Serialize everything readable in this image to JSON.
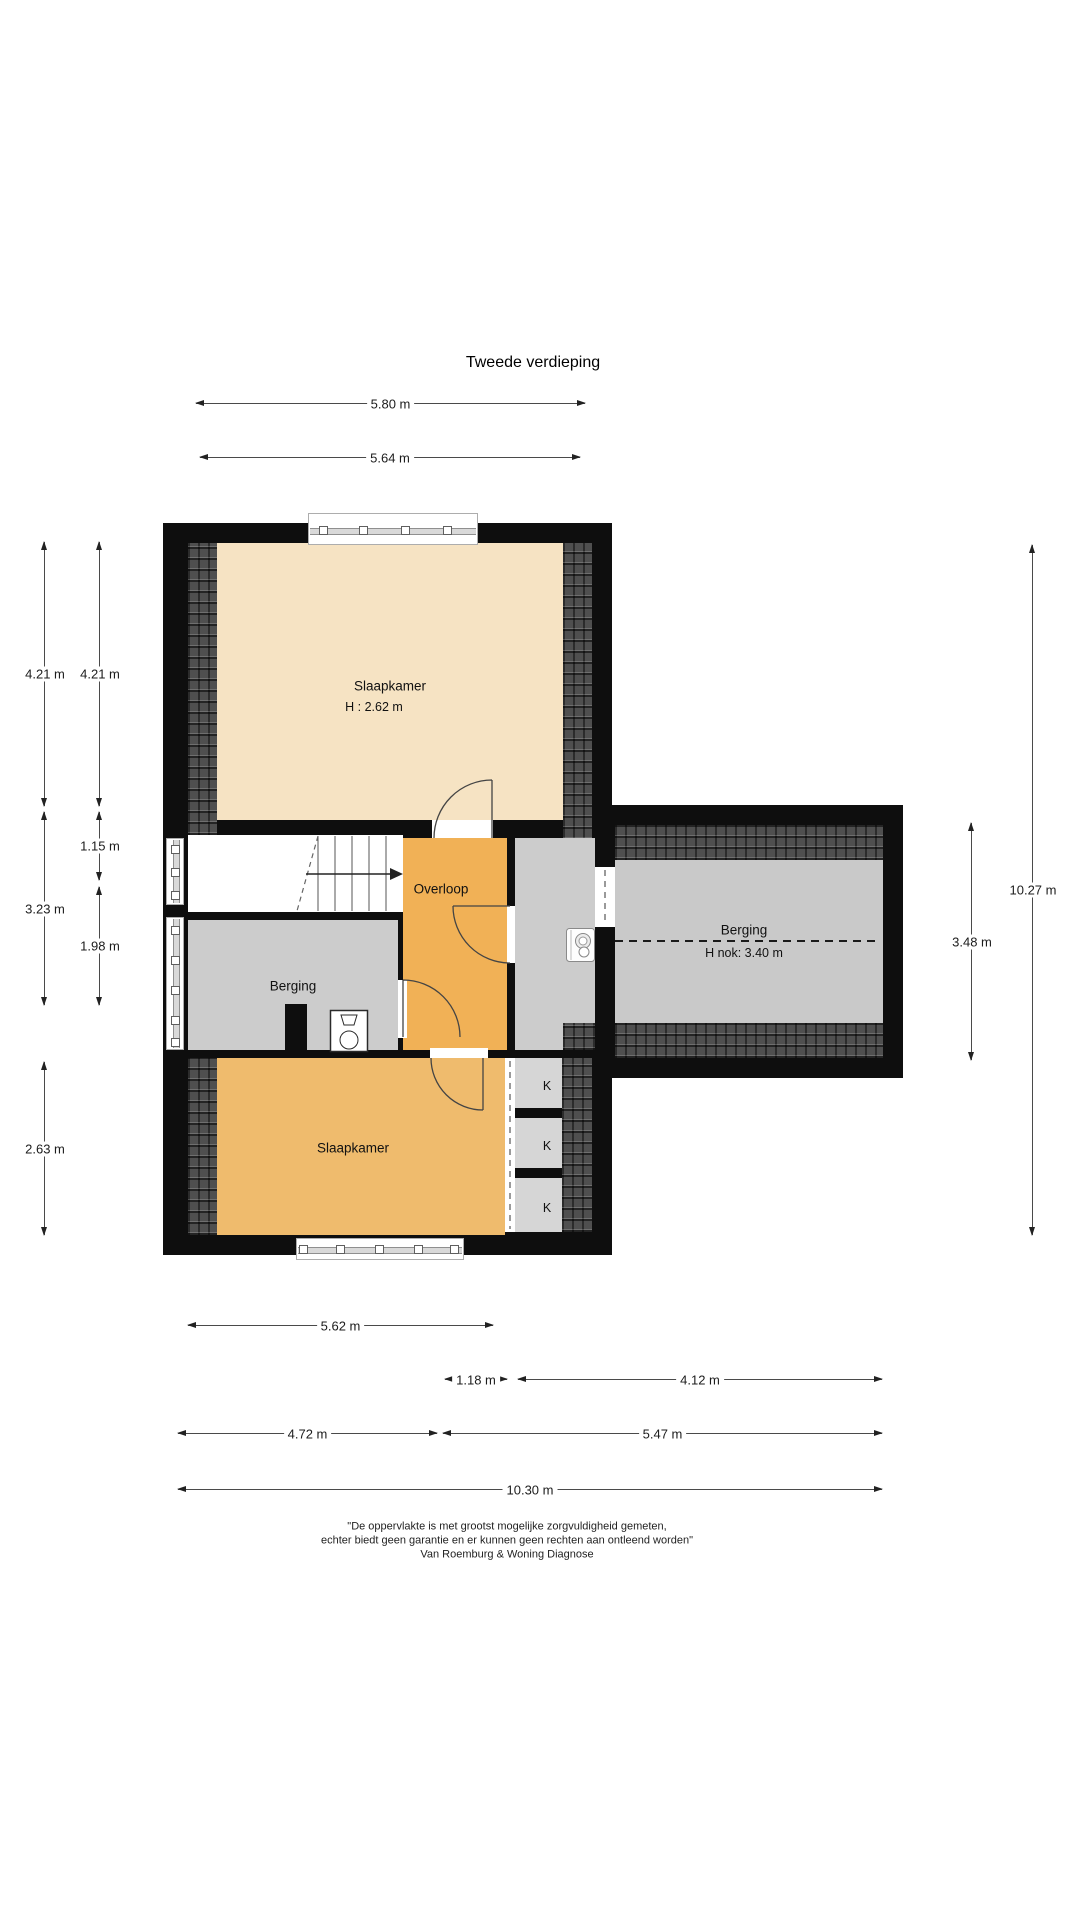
{
  "title": "Tweede verdieping",
  "floor_plan": {
    "rooms": [
      {
        "id": "slaapkamer-top",
        "label": "Slaapkamer",
        "sub": "H : 2.62 m",
        "lx": 390,
        "ly": 686,
        "sx": 374,
        "sy": 707
      },
      {
        "id": "overloop",
        "label": "Overloop",
        "lx": 441,
        "ly": 889
      },
      {
        "id": "berging-left",
        "label": "Berging",
        "lx": 293,
        "ly": 986
      },
      {
        "id": "berging-right",
        "label": "Berging",
        "sub": "H nok: 3.40 m",
        "lx": 744,
        "ly": 930,
        "sx": 744,
        "sy": 953
      },
      {
        "id": "slaapkamer-bottom",
        "label": "Slaapkamer",
        "lx": 353,
        "ly": 1148
      },
      {
        "id": "kast-1",
        "label": "K",
        "lx": 547,
        "ly": 1086,
        "small": true
      },
      {
        "id": "kast-2",
        "label": "K",
        "lx": 547,
        "ly": 1146,
        "small": true
      },
      {
        "id": "kast-3",
        "label": "K",
        "lx": 547,
        "ly": 1208,
        "small": true
      }
    ],
    "colors": {
      "wall": "#0e0e0e",
      "slaapkamer_top": "#f6e3c3",
      "overloop": "#f1b156",
      "slaapkamer_bottom": "#efbb6d",
      "berging_left": "#cccccc",
      "berging_right": "#c9c9c9",
      "kast": "#d6d6d6",
      "roof_hatch": "#4f4f4f"
    },
    "icons": [
      "stair-direction-arrow",
      "toilet-icon",
      "washer-icon",
      "chimney-block"
    ]
  },
  "dimensions": [
    {
      "label": "5.80 m",
      "dir": "h",
      "x1": 196,
      "x2": 585,
      "y": 403
    },
    {
      "label": "5.64 m",
      "dir": "h",
      "x1": 200,
      "x2": 580,
      "y": 457
    },
    {
      "label": "4.21 m",
      "dir": "v",
      "x": 44,
      "y1": 542,
      "y2": 806
    },
    {
      "label": "4.21 m",
      "dir": "v",
      "x": 99,
      "y1": 542,
      "y2": 806
    },
    {
      "label": "1.15 m",
      "dir": "v",
      "x": 99,
      "y1": 812,
      "y2": 880
    },
    {
      "label": "3.23 m",
      "dir": "v",
      "x": 44,
      "y1": 812,
      "y2": 1005
    },
    {
      "label": "1.98 m",
      "dir": "v",
      "x": 99,
      "y1": 887,
      "y2": 1005
    },
    {
      "label": "2.63 m",
      "dir": "v",
      "x": 44,
      "y1": 1062,
      "y2": 1235
    },
    {
      "label": "3.48 m",
      "dir": "v",
      "x": 971,
      "y1": 823,
      "y2": 1060
    },
    {
      "label": "10.27 m",
      "dir": "v",
      "x": 1032,
      "y1": 545,
      "y2": 1235
    },
    {
      "label": "5.62 m",
      "dir": "h",
      "x1": 188,
      "x2": 493,
      "y": 1325
    },
    {
      "label": "1.18 m",
      "dir": "h",
      "x1": 445,
      "x2": 507,
      "y": 1379
    },
    {
      "label": "4.12 m",
      "dir": "h",
      "x1": 518,
      "x2": 882,
      "y": 1379
    },
    {
      "label": "4.72 m",
      "dir": "h",
      "x1": 178,
      "x2": 437,
      "y": 1433
    },
    {
      "label": "5.47 m",
      "dir": "h",
      "x1": 443,
      "x2": 882,
      "y": 1433
    },
    {
      "label": "10.30 m",
      "dir": "h",
      "x1": 178,
      "x2": 882,
      "y": 1489
    }
  ],
  "disclaimer": [
    "\"De oppervlakte is met grootst mogelijke zorgvuldigheid gemeten,",
    "echter biedt geen garantie en er kunnen geen rechten aan ontleend worden\"",
    "Van Roemburg & Woning Diagnose"
  ]
}
